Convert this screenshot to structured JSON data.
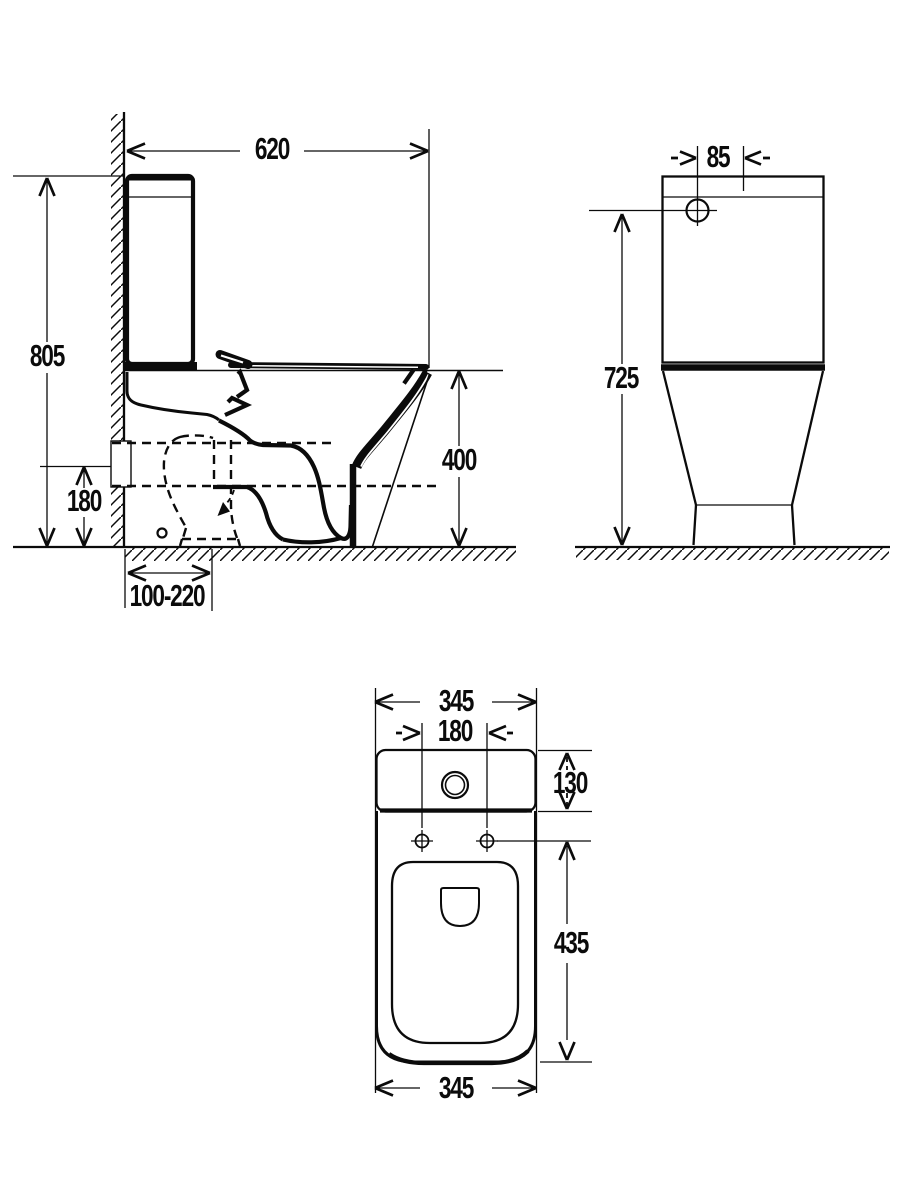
{
  "colors": {
    "ink": "#0b0b0b",
    "background": "#ffffff"
  },
  "views": {
    "side": {
      "dim_width": "620",
      "dim_overall_height": "805",
      "dim_rim_height": "400",
      "dim_outlet_center_height": "180",
      "dim_outlet_wall_distance": "100-220"
    },
    "front": {
      "dim_inlet_offset": "85",
      "dim_inlet_height": "725"
    },
    "top": {
      "dim_overall_width": "345",
      "dim_fixing_centres": "180",
      "dim_cistern_depth": "130",
      "dim_pan_length": "435",
      "dim_base_width": "345"
    }
  }
}
